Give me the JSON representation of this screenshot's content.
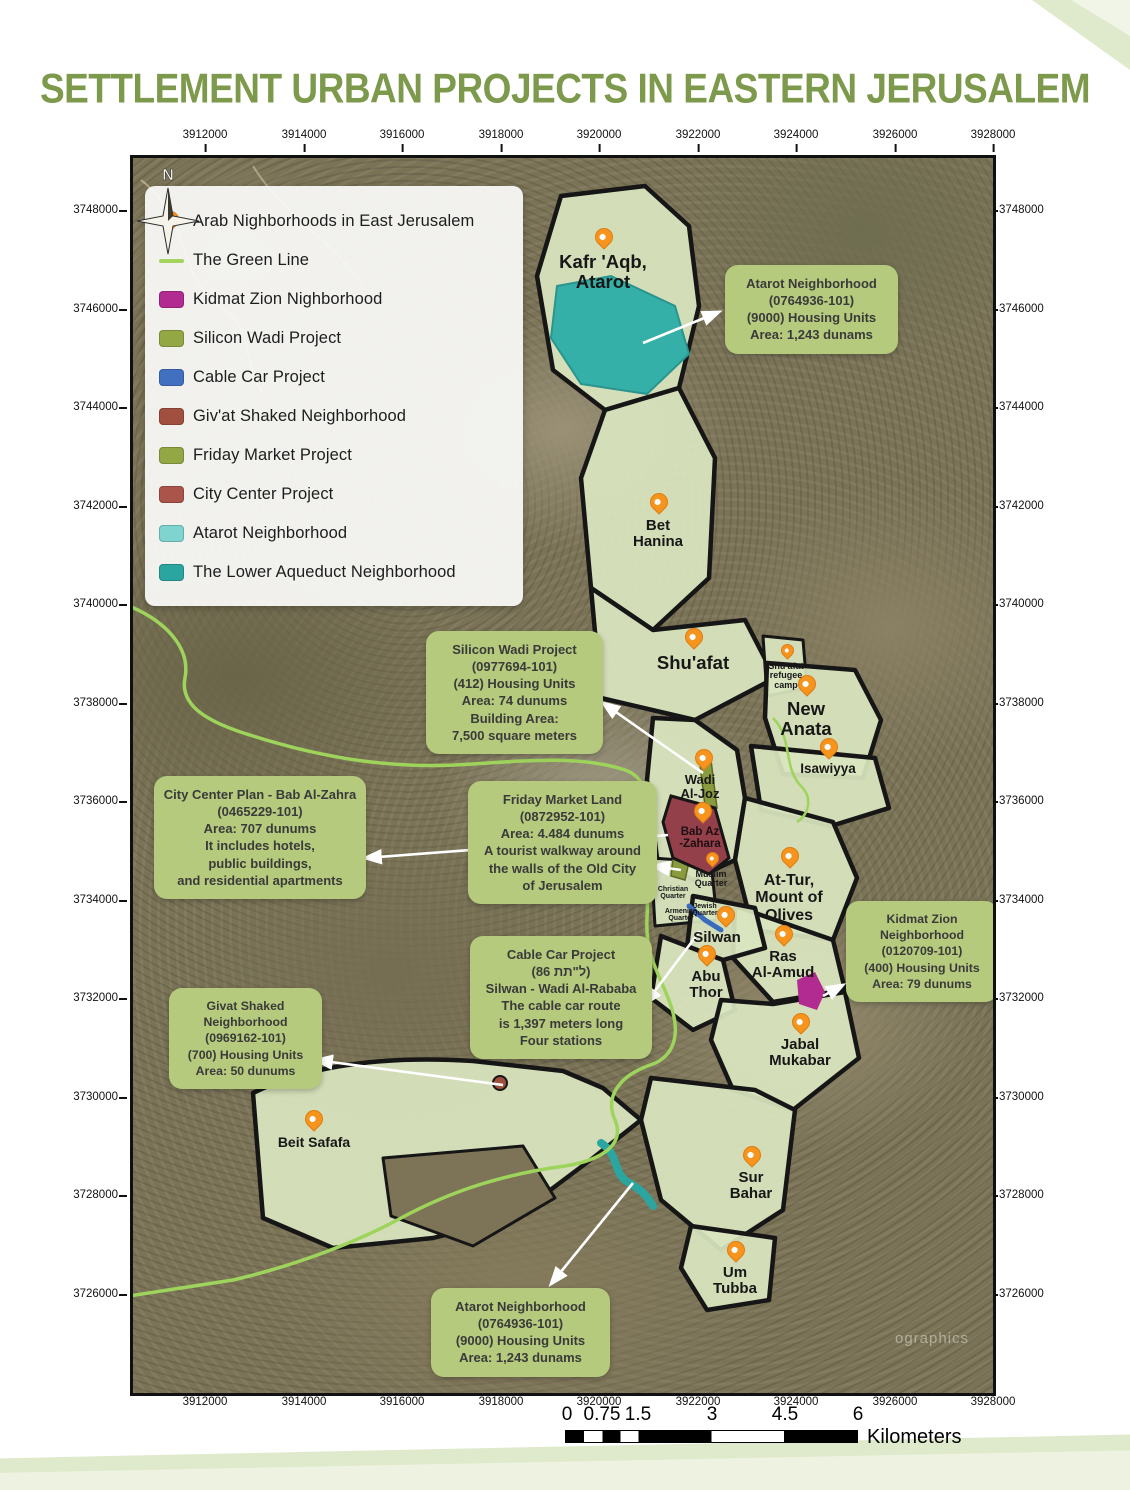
{
  "title": "SETTLEMENT URBAN PROJECTS IN EASTERN JERUSALEM",
  "axes": {
    "x_labels": [
      "3912000",
      "3914000",
      "3916000",
      "3918000",
      "3920000",
      "3922000",
      "3924000",
      "3926000",
      "3928000"
    ],
    "y_labels": [
      "3748000",
      "3746000",
      "3744000",
      "3742000",
      "3740000",
      "3738000",
      "3736000",
      "3734000",
      "3732000",
      "3730000",
      "3728000",
      "3726000"
    ]
  },
  "legend": {
    "items": [
      {
        "label": "Arab Nighborhoods in East Jerusalem",
        "color": "#f7941d"
      },
      {
        "label": "The Green Line",
        "color": "#a2d45e"
      },
      {
        "label": "Kidmat Zion Nighborhood",
        "color": "#b12b91"
      },
      {
        "label": "Silicon Wadi Project",
        "color": "#93a844"
      },
      {
        "label": "Cable Car Project",
        "color": "#4170c1"
      },
      {
        "label": "Giv'at Shaked Neighborhood",
        "color": "#a1503f"
      },
      {
        "label": "Friday Market Project",
        "color": "#93a844"
      },
      {
        "label": "City Center Project",
        "color": "#aa544a"
      },
      {
        "label": "Atarot Neighborhood",
        "color": "#7fd4cf"
      },
      {
        "label": "The Lower Aqueduct Neighborhood",
        "color": "#2aa5a0"
      }
    ]
  },
  "places": {
    "kafr_aqb": {
      "lines": [
        "Kafr 'Aqb,",
        "Atarot"
      ]
    },
    "bet_hanina": {
      "lines": [
        "Bet",
        "Hanina"
      ]
    },
    "shuafat": {
      "lines": [
        "Shu'afat"
      ]
    },
    "refugee_camp": {
      "lines": [
        "Shu'afat",
        "refugee",
        "camp"
      ]
    },
    "new_anata": {
      "lines": [
        "New",
        "Anata"
      ]
    },
    "isawiyya": {
      "lines": [
        "Isawiyya"
      ]
    },
    "wadi_al_joz": {
      "lines": [
        "Wadi",
        "Al-Joz"
      ]
    },
    "bab_az_zahara": {
      "lines": [
        "Bab Az",
        "-Zahara"
      ]
    },
    "muslim_quarter": {
      "lines": [
        "Muslim",
        "Quarter"
      ]
    },
    "christian_quarter": {
      "lines": [
        "Christian",
        "Quarter"
      ]
    },
    "armenian_quarter": {
      "lines": [
        "Armenian",
        "Quarter"
      ]
    },
    "jewish_quarter": {
      "lines": [
        "Jewish",
        "Quarter"
      ]
    },
    "at_tur": {
      "lines": [
        "At-Tur,",
        "Mount of",
        "Olives"
      ]
    },
    "silwan": {
      "lines": [
        "Silwan"
      ]
    },
    "abu_thor": {
      "lines": [
        "Abu",
        "Thor"
      ]
    },
    "ras_al_amud": {
      "lines": [
        "Ras",
        "Al-Amud"
      ]
    },
    "jabal_mukabar": {
      "lines": [
        "Jabal",
        "Mukabar"
      ]
    },
    "sur_bahar": {
      "lines": [
        "Sur",
        "Bahar"
      ]
    },
    "um_tubba": {
      "lines": [
        "Um",
        "Tubba"
      ]
    },
    "beit_safafa": {
      "lines": [
        "Beit Safafa"
      ]
    }
  },
  "callouts": {
    "atarot_top": {
      "lines": [
        "Atarot Neighborhood",
        "(0764936-101)",
        "(9000) Housing Units",
        "Area: 1,243 dunams"
      ]
    },
    "silicon_wadi": {
      "lines": [
        "Silicon Wadi Project",
        "(0977694-101)",
        "(412) Housing Units",
        "Area: 74 dunums",
        "Building Area:",
        "7,500 square meters"
      ]
    },
    "city_center": {
      "lines": [
        "City Center Plan - Bab Al-Zahra",
        "(0465229-101)",
        "Area: 707 dunums",
        "It includes hotels,",
        "public buildings,",
        "and residential apartments"
      ]
    },
    "friday_market": {
      "lines": [
        "Friday Market Land",
        "(0872952-101)",
        "Area: 4.484 dunums",
        "A tourist walkway around",
        "the walls of the Old City",
        "of Jerusalem"
      ]
    },
    "cable_car": {
      "lines": [
        "Cable Car Project",
        "‭(86 תת\"ל)‬",
        "Silwan - Wadi Al-Rababa",
        "The cable car route",
        "is 1,397 meters long",
        "Four stations"
      ]
    },
    "kidmat_zion": {
      "lines": [
        "Kidmat Zion",
        "Neighborhood",
        "(0120709-101)",
        "(400) Housing Units",
        "Area: 79 dunums"
      ]
    },
    "givat_shaked": {
      "lines": [
        "Givat Shaked",
        "Neighborhood",
        "(0969162-101)",
        "(700) Housing Units",
        "Area: 50 dunums"
      ]
    },
    "atarot_bottom": {
      "lines": [
        "Atarot Neighborhood",
        "(0764936-101)",
        "(9000) Housing Units",
        "Area: 1,243 dunams"
      ]
    }
  },
  "scalebar": {
    "ticks": [
      "0",
      "0.75",
      "1.5",
      "3",
      "4.5",
      "6"
    ],
    "unit": "Kilometers"
  },
  "compass": {
    "label": "N"
  },
  "watermark": {
    "text": "ographics"
  },
  "colors": {
    "title": "#7d9a4c",
    "callout_bg": "#b5ca7d",
    "pin": "#f7941d",
    "green_line": "#9ed45c",
    "settlement_fill": "#d9e5c0",
    "city_center_polygon": "#93404b",
    "kidmat_zion_polygon": "#b12b91",
    "atarot_polygon": "#35b0a8",
    "cable_car_line": "#3b6bbf",
    "aqueduct_polygon": "#2aa5a0"
  }
}
